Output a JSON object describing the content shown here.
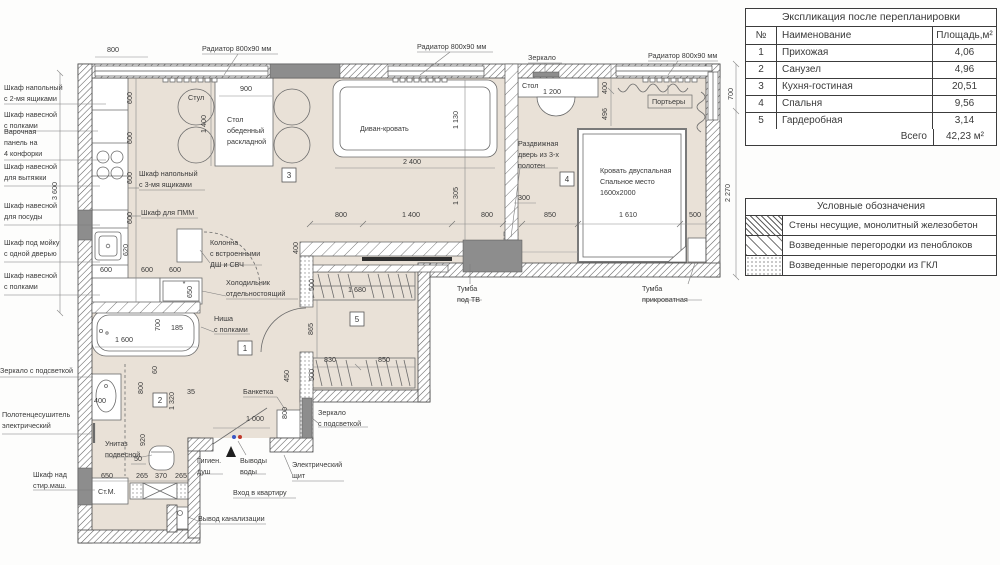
{
  "table": {
    "title": "Экспликация после перепланировки",
    "headers": [
      "№",
      "Наименование",
      "Площадь,м²"
    ],
    "rows": [
      {
        "num": "1",
        "name": "Прихожая",
        "area": "4,06"
      },
      {
        "num": "2",
        "name": "Санузел",
        "area": "4,96"
      },
      {
        "num": "3",
        "name": "Кухня-гостиная",
        "area": "20,51"
      },
      {
        "num": "4",
        "name": "Спальня",
        "area": "9,56"
      },
      {
        "num": "5",
        "name": "Гардеробная",
        "area": "3,14"
      }
    ],
    "total_label": "Всего",
    "total_value": "42,23 м²"
  },
  "legend": {
    "title": "Условные обозначения",
    "items": [
      {
        "swatch": "sw-dense",
        "label": "Стены несущие, монолитный железобетон"
      },
      {
        "swatch": "sw-light",
        "label": "Возведенные перегородки из пеноблоков"
      },
      {
        "swatch": "sw-dots",
        "label": "Возведенные перегородки из ГКЛ"
      }
    ]
  },
  "colors": {
    "floor": "#e9e1d7",
    "wall_line": "#4a4a4a",
    "dark_fill": "#8d8d8d",
    "text": "#3a3a3a",
    "water_cold": "#3a56c4",
    "water_hot": "#c0392b"
  },
  "plan": {
    "room_numbers": [
      {
        "n": "1",
        "x": 245,
        "y": 348
      },
      {
        "n": "2",
        "x": 160,
        "y": 400
      },
      {
        "n": "3",
        "x": 289,
        "y": 175
      },
      {
        "n": "4",
        "x": 567,
        "y": 179
      },
      {
        "n": "5",
        "x": 357,
        "y": 319
      }
    ],
    "labels": [
      {
        "lines": [
          "Шкаф напольный",
          "с 2-мя ящиками"
        ],
        "x": 4,
        "y": 90
      },
      {
        "lines": [
          "Шкаф навесной",
          "с полками"
        ],
        "x": 4,
        "y": 117
      },
      {
        "lines": [
          "Варочная",
          "панель на",
          "4 конфорки"
        ],
        "x": 4,
        "y": 134
      },
      {
        "lines": [
          "Шкаф навесной",
          "для вытяжки"
        ],
        "x": 4,
        "y": 169
      },
      {
        "lines": [
          "Шкаф навесной",
          "для посуды"
        ],
        "x": 4,
        "y": 208
      },
      {
        "lines": [
          "Шкаф под мойку",
          "с одной дверью"
        ],
        "x": 4,
        "y": 245
      },
      {
        "lines": [
          "Шкаф навесной",
          "с полками"
        ],
        "x": 4,
        "y": 278
      },
      {
        "lines": [
          "Зеркало с подсветкой"
        ],
        "x": 0,
        "y": 373
      },
      {
        "lines": [
          "Полотенцесушитель",
          "электрический"
        ],
        "x": 2,
        "y": 417
      },
      {
        "lines": [
          "Шкаф над",
          "стир.маш."
        ],
        "x": 33,
        "y": 477
      },
      {
        "lines": [
          "Радиатор 800х90 мм"
        ],
        "x": 202,
        "y": 51
      },
      {
        "lines": [
          "Радиатор 800х90 мм"
        ],
        "x": 417,
        "y": 49
      },
      {
        "lines": [
          "Радиатор 800х90 мм"
        ],
        "x": 648,
        "y": 58
      },
      {
        "lines": [
          "Зеркало"
        ],
        "x": 528,
        "y": 60
      },
      {
        "lines": [
          "Стол"
        ],
        "x": 522,
        "y": 88
      },
      {
        "lines": [
          "Стул"
        ],
        "x": 188,
        "y": 100
      },
      {
        "lines": [
          "Стол",
          "обеденный",
          "раскладной"
        ],
        "x": 227,
        "y": 122
      },
      {
        "lines": [
          "Диван-кровать"
        ],
        "x": 360,
        "y": 131
      },
      {
        "lines": [
          "Портьеры"
        ],
        "x": 652,
        "y": 104,
        "boxed": true
      },
      {
        "lines": [
          "Раздвижная",
          "дверь из 3-х",
          "полотен"
        ],
        "x": 518,
        "y": 146
      },
      {
        "lines": [
          "Кровать двуспальная",
          "Спальное место",
          "1600х2000"
        ],
        "x": 600,
        "y": 173
      },
      {
        "lines": [
          "Шкаф напольный",
          "с 3-мя ящиками"
        ],
        "x": 139,
        "y": 176
      },
      {
        "lines": [
          "Шкаф для ПММ"
        ],
        "x": 141,
        "y": 215
      },
      {
        "lines": [
          "Колонна",
          "с встроенными",
          "ДШ и СВЧ"
        ],
        "x": 210,
        "y": 245
      },
      {
        "lines": [
          "Холодильник",
          "отдельностоящий"
        ],
        "x": 226,
        "y": 285
      },
      {
        "lines": [
          "Ниша",
          "с полками"
        ],
        "x": 214,
        "y": 321
      },
      {
        "lines": [
          "Тумба",
          "под ТВ"
        ],
        "x": 457,
        "y": 291
      },
      {
        "lines": [
          "Тумба",
          "прикроватная"
        ],
        "x": 642,
        "y": 291
      },
      {
        "lines": [
          "Банкетка"
        ],
        "x": 243,
        "y": 394
      },
      {
        "lines": [
          "Зеркало",
          "с подсветкой"
        ],
        "x": 318,
        "y": 415
      },
      {
        "lines": [
          "Унитаз",
          "подвесной"
        ],
        "x": 105,
        "y": 446
      },
      {
        "lines": [
          "Гигиен.",
          "душ"
        ],
        "x": 197,
        "y": 463
      },
      {
        "lines": [
          "Выводы",
          "воды"
        ],
        "x": 240,
        "y": 463
      },
      {
        "lines": [
          "Электрический",
          "щит"
        ],
        "x": 292,
        "y": 467
      },
      {
        "lines": [
          "Вход в квартиру"
        ],
        "x": 233,
        "y": 495
      },
      {
        "lines": [
          "Вывод канализации"
        ],
        "x": 198,
        "y": 521
      },
      {
        "lines": [
          "Ст.М."
        ],
        "x": 98,
        "y": 494
      }
    ],
    "dims": [
      {
        "t": "800",
        "x": 113,
        "y": 52
      },
      {
        "t": "900",
        "x": 246,
        "y": 91
      },
      {
        "t": "1 400",
        "x": 206,
        "y": 124,
        "v": 1
      },
      {
        "t": "2 400",
        "x": 412,
        "y": 164
      },
      {
        "t": "1 130",
        "x": 458,
        "y": 120,
        "v": 1
      },
      {
        "t": "1 200",
        "x": 552,
        "y": 94
      },
      {
        "t": "400",
        "x": 607,
        "y": 88,
        "v": 1
      },
      {
        "t": "496",
        "x": 607,
        "y": 114,
        "v": 1
      },
      {
        "t": "700",
        "x": 733,
        "y": 94,
        "v": 1
      },
      {
        "t": "2 270",
        "x": 730,
        "y": 193,
        "v": 1
      },
      {
        "t": "1 305",
        "x": 458,
        "y": 196,
        "v": 1
      },
      {
        "t": "300",
        "x": 524,
        "y": 200
      },
      {
        "t": "800",
        "x": 341,
        "y": 217
      },
      {
        "t": "1 400",
        "x": 411,
        "y": 217
      },
      {
        "t": "800",
        "x": 487,
        "y": 217
      },
      {
        "t": "850",
        "x": 550,
        "y": 217
      },
      {
        "t": "1 610",
        "x": 628,
        "y": 217
      },
      {
        "t": "500",
        "x": 695,
        "y": 217
      },
      {
        "t": "3 600",
        "x": 57,
        "y": 191,
        "v": 1
      },
      {
        "t": "600",
        "x": 132,
        "y": 98,
        "v": 1
      },
      {
        "t": "600",
        "x": 132,
        "y": 138,
        "v": 1
      },
      {
        "t": "600",
        "x": 132,
        "y": 178,
        "v": 1
      },
      {
        "t": "600",
        "x": 132,
        "y": 218,
        "v": 1
      },
      {
        "t": "620",
        "x": 128,
        "y": 250,
        "v": 1
      },
      {
        "t": "600",
        "x": 106,
        "y": 272
      },
      {
        "t": "600",
        "x": 147,
        "y": 272
      },
      {
        "t": "600",
        "x": 175,
        "y": 272
      },
      {
        "t": "650",
        "x": 192,
        "y": 292,
        "v": 1
      },
      {
        "t": "*",
        "x": 184,
        "y": 286
      },
      {
        "t": "1 600",
        "x": 124,
        "y": 342
      },
      {
        "t": "700",
        "x": 160,
        "y": 325,
        "v": 1
      },
      {
        "t": "185",
        "x": 177,
        "y": 330
      },
      {
        "t": "60",
        "x": 157,
        "y": 370,
        "v": 1
      },
      {
        "t": "800",
        "x": 143,
        "y": 388,
        "v": 1
      },
      {
        "t": "400",
        "x": 100,
        "y": 403
      },
      {
        "t": "920",
        "x": 145,
        "y": 440,
        "v": 1
      },
      {
        "t": "1 320",
        "x": 174,
        "y": 401,
        "v": 1
      },
      {
        "t": "35",
        "x": 191,
        "y": 394
      },
      {
        "t": "50",
        "x": 138,
        "y": 461
      },
      {
        "t": "650",
        "x": 107,
        "y": 478
      },
      {
        "t": "265",
        "x": 142,
        "y": 478
      },
      {
        "t": "370",
        "x": 161,
        "y": 478
      },
      {
        "t": "265",
        "x": 181,
        "y": 478
      },
      {
        "t": "1 000",
        "x": 255,
        "y": 421
      },
      {
        "t": "450",
        "x": 289,
        "y": 376,
        "v": 1
      },
      {
        "t": "800",
        "x": 287,
        "y": 413,
        "v": 1
      },
      {
        "t": "400",
        "x": 298,
        "y": 248,
        "v": 1
      },
      {
        "t": "500",
        "x": 314,
        "y": 285,
        "v": 1
      },
      {
        "t": "1 680",
        "x": 357,
        "y": 292
      },
      {
        "t": "865",
        "x": 313,
        "y": 329,
        "v": 1
      },
      {
        "t": "830",
        "x": 330,
        "y": 362
      },
      {
        "t": "850",
        "x": 384,
        "y": 362
      },
      {
        "t": "500",
        "x": 314,
        "y": 375,
        "v": 1
      }
    ]
  }
}
